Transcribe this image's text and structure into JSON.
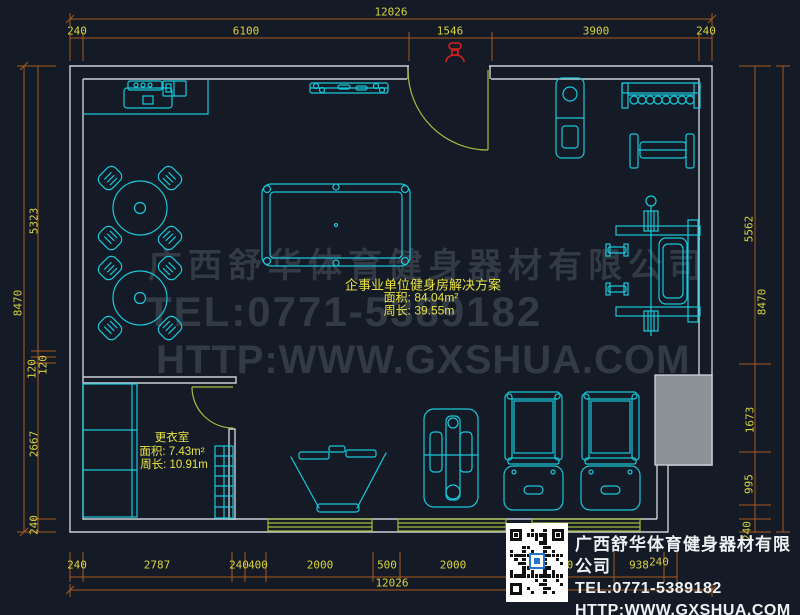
{
  "watermark": {
    "company": "广西舒华体育健身器材有限公司",
    "tel": "TEL:0771-5389182",
    "url": "HTTP:WWW.GXSHUA.COM"
  },
  "plan_label": {
    "title": "企事业单位健身房解决方案",
    "area": "面积: 84.04m²",
    "perimeter": "周长: 39.55m"
  },
  "changing_room": {
    "name": "更衣室",
    "area": "面积: 7.43m²",
    "perimeter": "周长: 10.91m"
  },
  "title_block": {
    "company": "广西舒华体育健身器材有限公司",
    "tel": "TEL:0771-5389182",
    "url": "HTTP:WWW.GXSHUA.COM"
  },
  "dimensions": {
    "top_total": "12026",
    "top": [
      "240",
      "6100",
      "1546",
      "3900",
      "240"
    ],
    "left_outer": "8470",
    "left": [
      "5323",
      "120",
      "120",
      "2667",
      "240"
    ],
    "right_outer": "8470",
    "right": [
      "5562",
      "1673",
      "995",
      "240"
    ],
    "bottom": [
      "240",
      "2787",
      "240",
      "400",
      "2000",
      "500",
      "2000",
      "2000",
      "938",
      "240"
    ],
    "bottom_total": "12026"
  },
  "colors": {
    "background": "#141b26",
    "line_cyan": "#19c8d9",
    "wall_gray": "#c9ced5",
    "dimension_orange": "#a9591e",
    "dimension_text": "#d8d23f",
    "door_green": "#a3bd3e",
    "watermark_gray": "#3c4452",
    "label_yellow": "#e8e342",
    "marker_red": "#d32020",
    "pillar_gray": "#8d9298",
    "title_text": "#eef1f4"
  }
}
